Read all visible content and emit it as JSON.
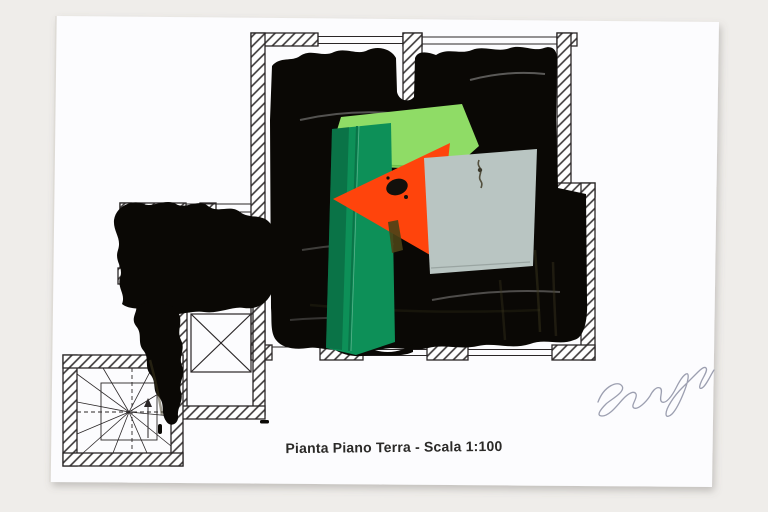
{
  "photo": {
    "background_color": "#efedea"
  },
  "paper": {
    "color": "#fcfcfe"
  },
  "plan": {
    "caption": "Pianta Piano Terra - Scala 1:100",
    "ink_color": "#2a2627",
    "features": [
      "hatched masonry walls",
      "window openings in outer walls",
      "winder stairwell",
      "elevator shaft marked with X"
    ]
  },
  "overpainting": {
    "paint_color": "#0a0805",
    "streak_color": "#3f3a20"
  },
  "collage": {
    "pieces": [
      {
        "name": "light-green-paper",
        "color": "#8fdc66"
      },
      {
        "name": "dark-green-paper",
        "color": "#0d9058"
      },
      {
        "name": "orange-triangle-paper",
        "color": "#ff440c"
      },
      {
        "name": "gray-blue-paper",
        "color": "#b9c5c2"
      }
    ]
  },
  "signature": {
    "pencil_color": "#979aac"
  }
}
